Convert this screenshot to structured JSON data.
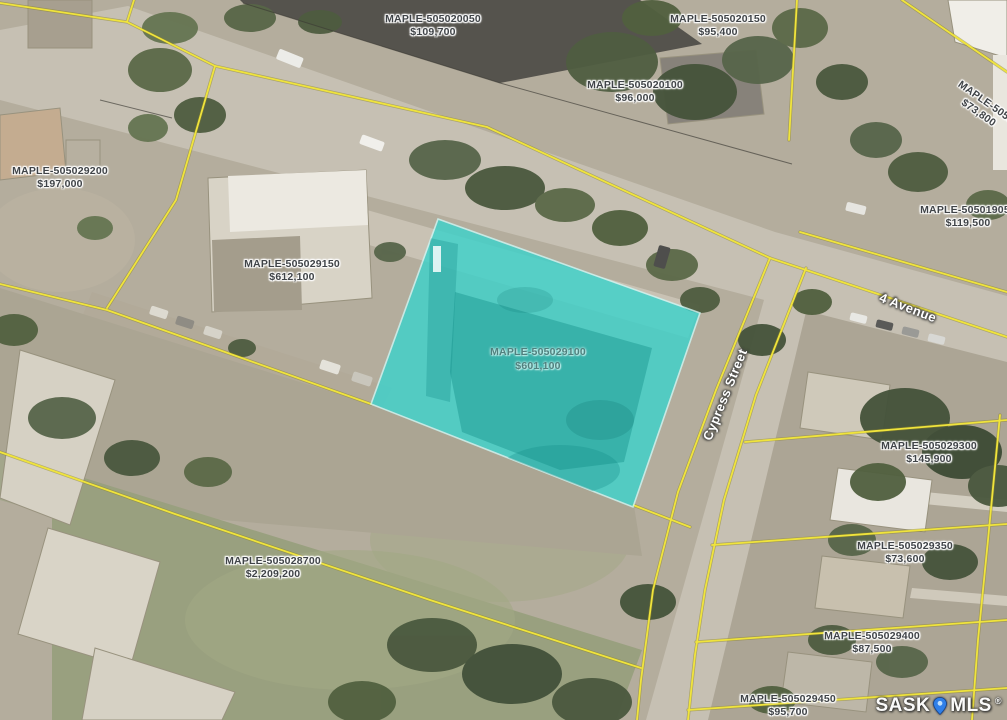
{
  "map": {
    "streets": [
      {
        "name": "Cypress Street"
      },
      {
        "name": "4 Avenue"
      }
    ],
    "watermark": {
      "left": "SASK",
      "right": "MLS",
      "reg": "®",
      "pin_color": "#2f7fe8"
    },
    "colors": {
      "highlight_fill": "#3ed2cb",
      "parcel_line": "#f0e43c"
    },
    "highlighted_parcel": {
      "id": "MAPLE-505029100",
      "value": "$601,100"
    },
    "parcels": [
      {
        "id": "MAPLE-505020050",
        "value": "$109,700"
      },
      {
        "id": "MAPLE-505020150",
        "value": "$95,400"
      },
      {
        "id": "MAPLE-505020100",
        "value": "$96,000"
      },
      {
        "id": "MAPLE-5050",
        "value": "$73,800"
      },
      {
        "id": "MAPLE-505029200",
        "value": "$197,000"
      },
      {
        "id": "MAPLE-505019050",
        "value": "$119,500"
      },
      {
        "id": "MAPLE-505029150",
        "value": "$612,100"
      },
      {
        "id": "MAPLE-505029300",
        "value": "$145,900"
      },
      {
        "id": "MAPLE-505029350",
        "value": "$73,600"
      },
      {
        "id": "MAPLE-505028700",
        "value": "$2,209,200"
      },
      {
        "id": "MAPLE-505029400",
        "value": "$87,500"
      },
      {
        "id": "MAPLE-505029450",
        "value": "$95,700"
      }
    ]
  }
}
